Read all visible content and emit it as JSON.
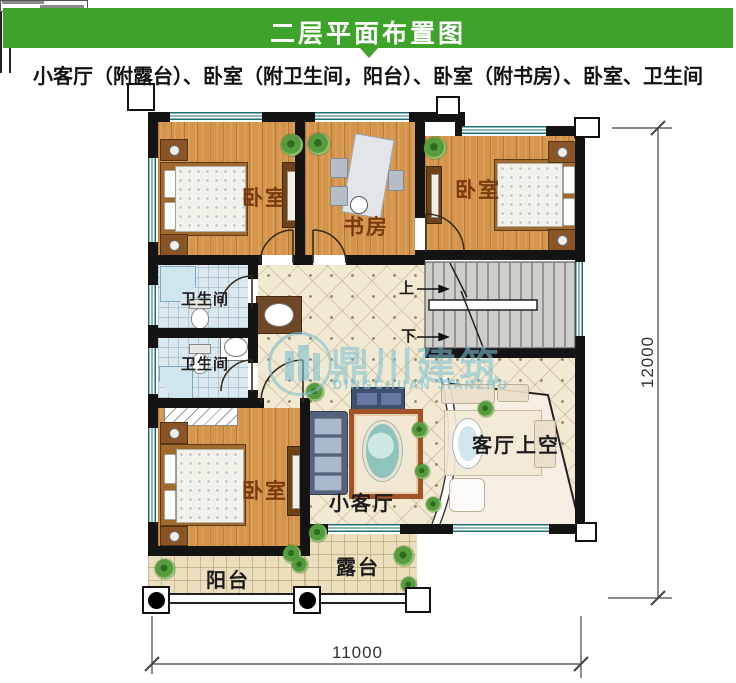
{
  "header": {
    "title": "二层平面布置图"
  },
  "subtitle": "小客厅（附露台）、卧室（附卫生间，阳台）、卧室（附书房）、卧室、卫生间",
  "rooms": {
    "bedroom_top_left": "卧室",
    "study": "书房",
    "bedroom_top_right": "卧室",
    "bathroom_upper": "卫生间",
    "bathroom_lower": "卫生间",
    "bedroom_bottom": "卧室",
    "small_living": "小客厅",
    "living_void": "客厅上空",
    "balcony": "阳台",
    "terrace": "露台"
  },
  "stairs": {
    "up_label": "上",
    "down_label": "下"
  },
  "dimensions": {
    "bottom_width": "11000",
    "right_height": "12000"
  },
  "watermark": {
    "name_cn": "鼎川建筑",
    "name_en": "DINGCHUAN JIANZHU"
  },
  "colors": {
    "header_green": "#3ea32b",
    "wall_black": "#141414",
    "wood_floor": "#d4944a",
    "hall_tile": "#f1e9d2",
    "bath_tile": "#dbe9ef",
    "watermark_blue": "#7dc0d2"
  }
}
